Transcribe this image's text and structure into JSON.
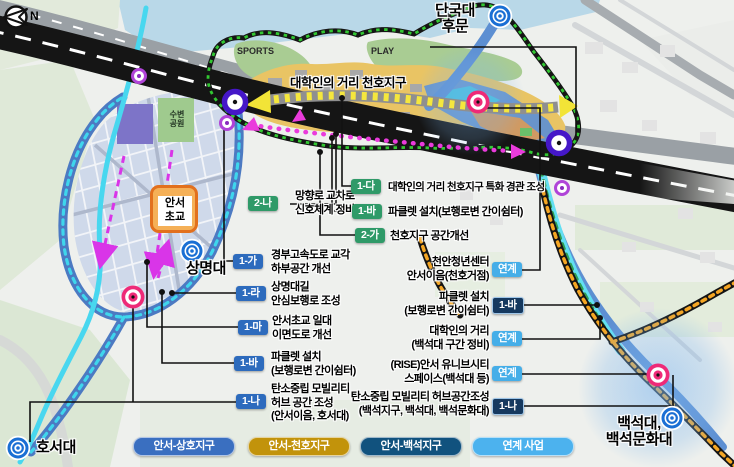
{
  "compass": {
    "label": "N"
  },
  "landmarks": {
    "dankook_gate": "단국대\n후문",
    "sangmyung": "상명대",
    "hoseo": "호서대",
    "baekseok": "백석대,\n백석문화대"
  },
  "map_labels": {
    "cheonho_street": "대학인의 거리 천호지구",
    "sports": "SPORTS",
    "play": "PLAY",
    "waterside_park": "수변\n공원",
    "anseo_elementary": "안서\n초교"
  },
  "callouts": {
    "center": [
      {
        "badge": "2-나",
        "text": "망향로 교차로\n신호체계 정비"
      },
      {
        "badge": "1-다",
        "text": "대학인의 거리 천호지구 특화 경관 조성"
      },
      {
        "badge": "1-바",
        "text": "파클렛 설치(보행로변 간이쉼터)"
      },
      {
        "badge": "2-가",
        "text": "천호지구 공간개선"
      }
    ],
    "left": [
      {
        "badge": "1-가",
        "text": "경부고속도로 교각\n하부공간 개선"
      },
      {
        "badge": "1-라",
        "text": "상명대길\n안심보행로 조성"
      },
      {
        "badge": "1-마",
        "text": "안서초교 일대\n이면도로 개선"
      },
      {
        "badge": "1-바",
        "text": "파클렛 설치\n(보행로변 간이쉼터)"
      },
      {
        "badge": "1-나",
        "text": "탄소중립 모빌리티\n허브 공간 조성\n(안서이음, 호서대)"
      }
    ],
    "right": [
      {
        "badge": "연계",
        "text": "천안청년센터\n안서이음(천호거점)"
      },
      {
        "badge": "1-바",
        "text": "파클렛 설치\n(보행로변 간이쉼터)"
      },
      {
        "badge": "연계",
        "text": "대학인의 거리\n(백석대 구간 정비)"
      },
      {
        "badge": "연계",
        "text": "(RISE)안서 유니브시티\n스페이스(백석대 등)"
      },
      {
        "badge": "1-나",
        "text": "탄소중립 모빌리티 허브공간조성\n(백석지구, 백석대, 백석문화대)"
      }
    ]
  },
  "legend": [
    {
      "label": "안서-상호지구",
      "color": "#3a6fc0"
    },
    {
      "label": "안서-천호지구",
      "color": "#c2930b"
    },
    {
      "label": "안서-백석지구",
      "color": "#11527e"
    },
    {
      "label": "연계 사업",
      "color": "#4cb2ee"
    }
  ],
  "colors": {
    "badge_blue": "#2d6bbd",
    "badge_green": "#2f9a68",
    "badge_navy": "#16395f",
    "badge_link": "#45aee8",
    "district_gold": "#e9c464",
    "park_green": "#a9cc93",
    "water": "#b9d8e8",
    "stream_cyan": "#48d7ef",
    "ring_road_blue": "#4c7ac2",
    "highway_black": "#151515",
    "border_dot_green": "#32c832",
    "dot_magenta": "#ea3bdc",
    "path_orange": "#f5a623",
    "hub_pink": "#ee2a78",
    "gate_blue": "#1a6fd4",
    "node_purple": "#4517c8"
  }
}
